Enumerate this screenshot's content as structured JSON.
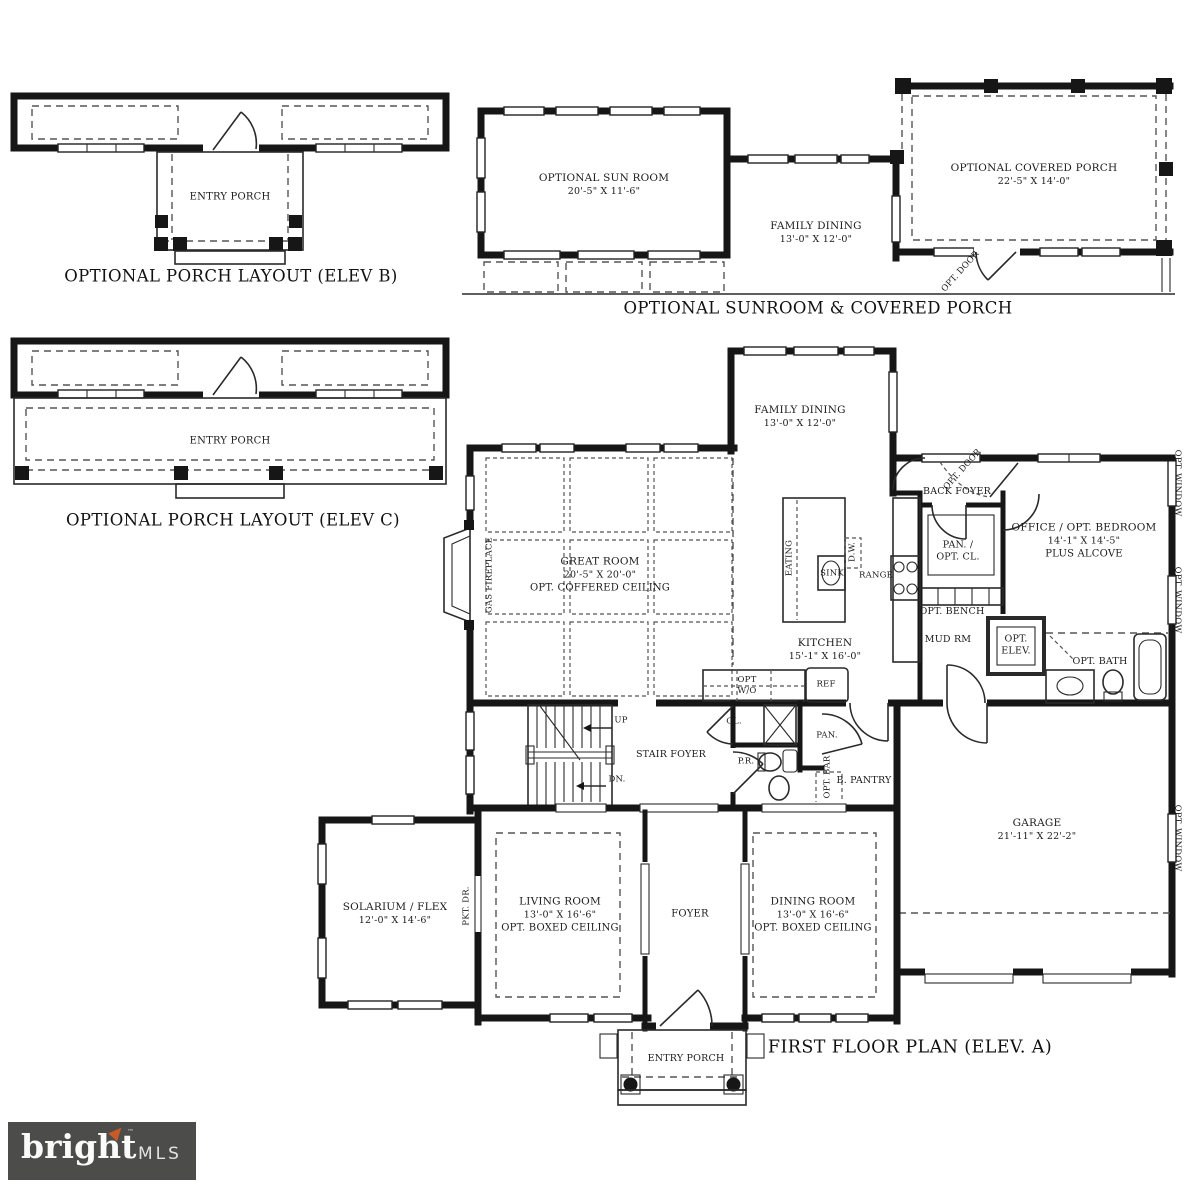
{
  "captions": {
    "elev_b": "OPTIONAL PORCH LAYOUT (ELEV B)",
    "elev_c": "OPTIONAL PORCH LAYOUT (ELEV C)",
    "sunroom_porch": "OPTIONAL SUNROOM & COVERED PORCH",
    "first_floor": "FIRST FLOOR PLAN (ELEV. A)"
  },
  "elev_b": {
    "entry_porch": "ENTRY PORCH"
  },
  "elev_c": {
    "entry_porch": "ENTRY PORCH"
  },
  "sunroom_plan": {
    "sun_room": {
      "name": "OPTIONAL SUN ROOM",
      "dims": "20'-5\" X 11'-6\""
    },
    "family_dining": {
      "name": "FAMILY DINING",
      "dims": "13'-0\" X 12'-0\""
    },
    "covered_porch": {
      "name": "OPTIONAL COVERED PORCH",
      "dims": "22'-5\" X 14'-0\""
    },
    "opt_door": "OPT. DOOR"
  },
  "first_floor": {
    "family_dining": {
      "name": "FAMILY DINING",
      "dims": "13'-0\" X 12'-0\""
    },
    "opt_door": "OPT. DOOR",
    "back_foyer": "BACK FOYER",
    "office": {
      "line1": "OFFICE / OPT. BEDROOM",
      "dims": "14'-1\" X 14'-5\"",
      "line3": "PLUS ALCOVE"
    },
    "opt_window": "OPT. WINDOW",
    "great_room": {
      "name": "GREAT ROOM",
      "dims": "20'-5\" X 20'-0\"",
      "line3": "OPT. COFFERED CEILING"
    },
    "gas_fireplace": "GAS FIREPLACE",
    "kitchen": {
      "name": "KITCHEN",
      "dims": "15'-1\" X 16'-0\""
    },
    "eating": "EATING",
    "sink": "SINK",
    "dw": "D.W.",
    "range": "RANGE",
    "pan_opt_cl": {
      "line1": "PAN. /",
      "line2": "OPT. CL."
    },
    "opt_bench": "OPT. BENCH",
    "mud_rm": "MUD RM",
    "opt_elev": {
      "line1": "OPT.",
      "line2": "ELEV."
    },
    "opt_bath": "OPT. BATH",
    "opt_wo": {
      "line1": "OPT",
      "line2": "W/O"
    },
    "ref": "REF",
    "cl": "CL.",
    "pan": "PAN.",
    "pr": "P.R.",
    "opt_bar": "OPT. BAR",
    "b_pantry": "B. PANTRY",
    "stair_foyer": "STAIR FOYER",
    "up": "UP",
    "dn": "DN.",
    "garage": {
      "name": "GARAGE",
      "dims": "21'-11\" X 22'-2\""
    },
    "solarium": {
      "name": "SOLARIUM / FLEX",
      "dims": "12'-0\" X 14'-6\""
    },
    "pkt_dr": "PKT. DR.",
    "living_room": {
      "name": "LIVING ROOM",
      "dims": "13'-0\" X 16'-6\"",
      "line3": "OPT. BOXED CEILING"
    },
    "foyer": "FOYER",
    "dining_room": {
      "name": "DINING ROOM",
      "dims": "13'-0\" X 16'-6\"",
      "line3": "OPT. BOXED CEILING"
    },
    "entry_porch": "ENTRY PORCH"
  },
  "logo": {
    "brand": "bright",
    "suffix": "MLS",
    "tm": "™",
    "bg": "#4c4c4a",
    "arrow_color": "#c75b28"
  }
}
